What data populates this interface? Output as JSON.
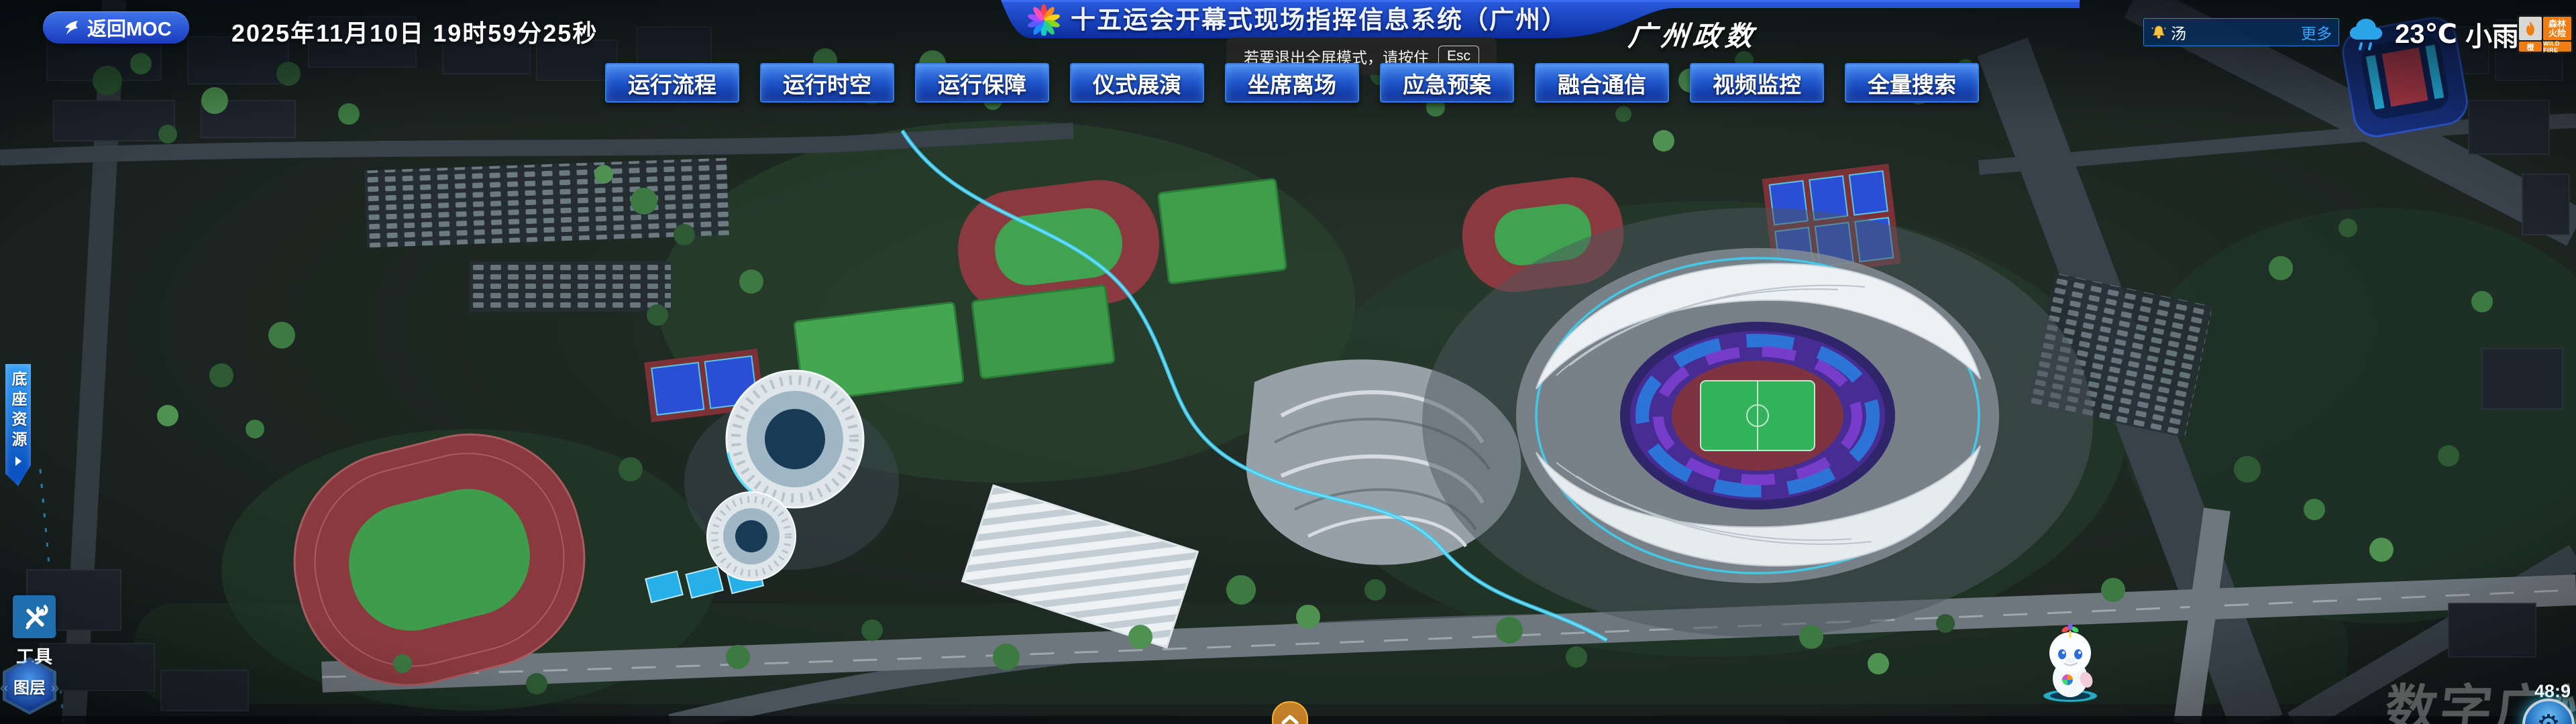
{
  "header": {
    "back_button": "返回MOC",
    "datetime": "2025年11月10日 19时59分25秒",
    "title": "十五运会开幕式现场指挥信息系统（广州）",
    "org": "广州政数",
    "fullscreen_tip": {
      "text": "若要退出全屏模式，请按住",
      "key": "Esc"
    },
    "ticker": {
      "text": "汤",
      "more": "更多"
    },
    "weather": {
      "temp": "23℃",
      "condition": "小雨"
    },
    "fire_badge": {
      "name_line1": "森林",
      "name_line2": "火险",
      "level": "橙",
      "en": "WILD FIRE"
    }
  },
  "nav": {
    "items": [
      "运行流程",
      "运行时空",
      "运行保障",
      "仪式展演",
      "坐席离场",
      "应急预案",
      "融合通信",
      "视频监控",
      "全量搜索"
    ]
  },
  "side": {
    "base_resources": "底座资源",
    "tools": "工具",
    "layers": "图层"
  },
  "footer": {
    "watermark": "数字广州",
    "aspect_ratio": "48:9"
  },
  "icons": {
    "gear_glyph": "⚙",
    "hex_chevron_left": "‹‹",
    "hex_chevron_right": "››"
  },
  "colors": {
    "banner_blue": "#1c46c8",
    "nav_border": "#2e7de8",
    "accent_cyan": "#38d6f8",
    "alert_orange": "#ef7d13"
  }
}
